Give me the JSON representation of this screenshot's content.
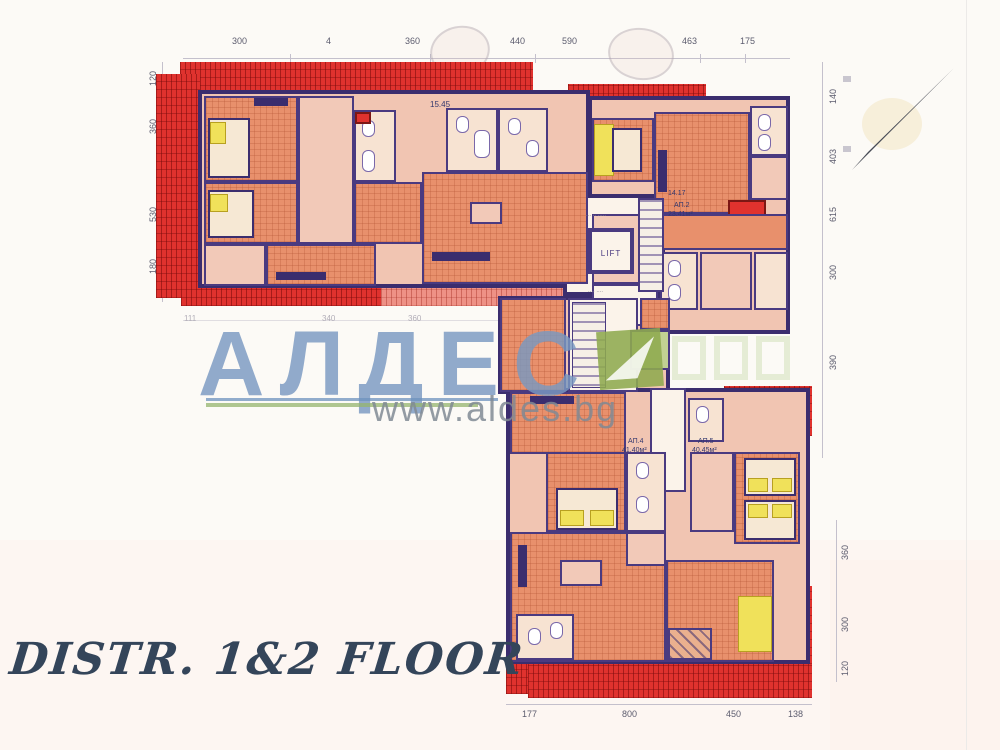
{
  "title": {
    "text": "DISTR. 1&2 FLOOR"
  },
  "watermark": {
    "brand": "АЛДЕС",
    "url": "www.aldes.bg"
  },
  "core": {
    "lift": "LIFT"
  },
  "room_labels": {
    "k1545": "15.45",
    "h1417": "14.17",
    "ap2": "АП.2",
    "ap2_area": "23.41м²",
    "ap4": "АП.4",
    "ap4_area": "41.40м²",
    "ap5": "АП.5",
    "ap5_area": "40.45м²"
  },
  "dims": {
    "top": [
      "300",
      "4",
      "360",
      "440",
      "590",
      "463",
      "175"
    ],
    "right_upper": [
      "140",
      "403",
      "615",
      "300",
      "390"
    ],
    "right_lower": [
      "360",
      "300",
      "120"
    ],
    "bottom": [
      "177",
      "800",
      "450",
      "138"
    ],
    "left": [
      "120",
      "360",
      "530",
      "180"
    ],
    "inner": [
      "111",
      "340",
      "360"
    ]
  },
  "colors": {
    "roof_red": "#e0322e",
    "wall_indigo": "#3b2d6e",
    "room_salmon": "#e8906c",
    "watermark_blue": "#7998c1",
    "watermark_green": "#8eaa4e",
    "url_gray": "#828a94",
    "title_ink": "#34455a"
  }
}
